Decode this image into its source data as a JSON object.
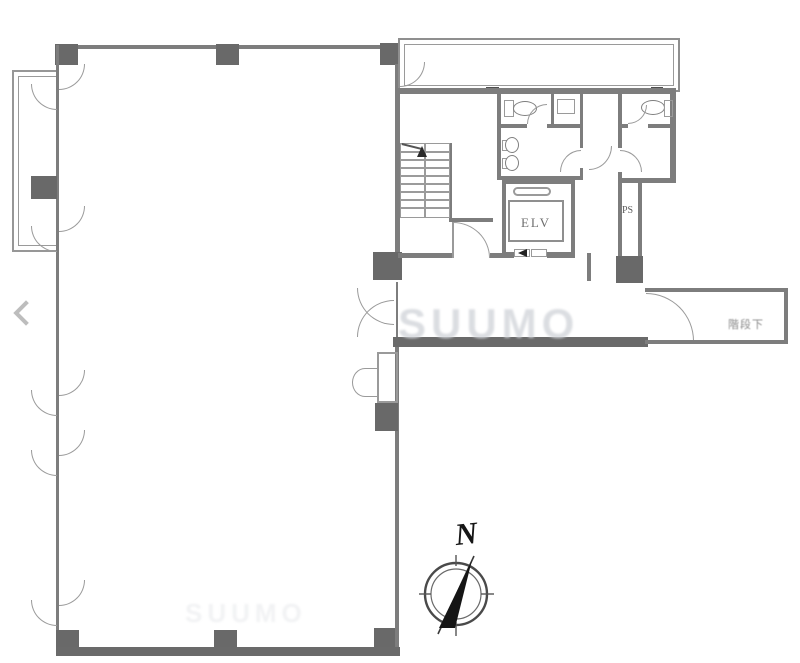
{
  "labels": {
    "elevator": "ELV",
    "pipe_shaft": "PS",
    "under_stairs": "階段下",
    "compass_north": "N"
  },
  "watermark": {
    "text": "SUUMO"
  },
  "colors": {
    "wall_thick": "#6a6a6a",
    "wall_thin": "#8b8b8b",
    "arc_line": "#9a9a9a",
    "compass_ink": "#161616",
    "watermark_tint": "#d2d5da",
    "nav_arrow": "#bdbdbd"
  }
}
